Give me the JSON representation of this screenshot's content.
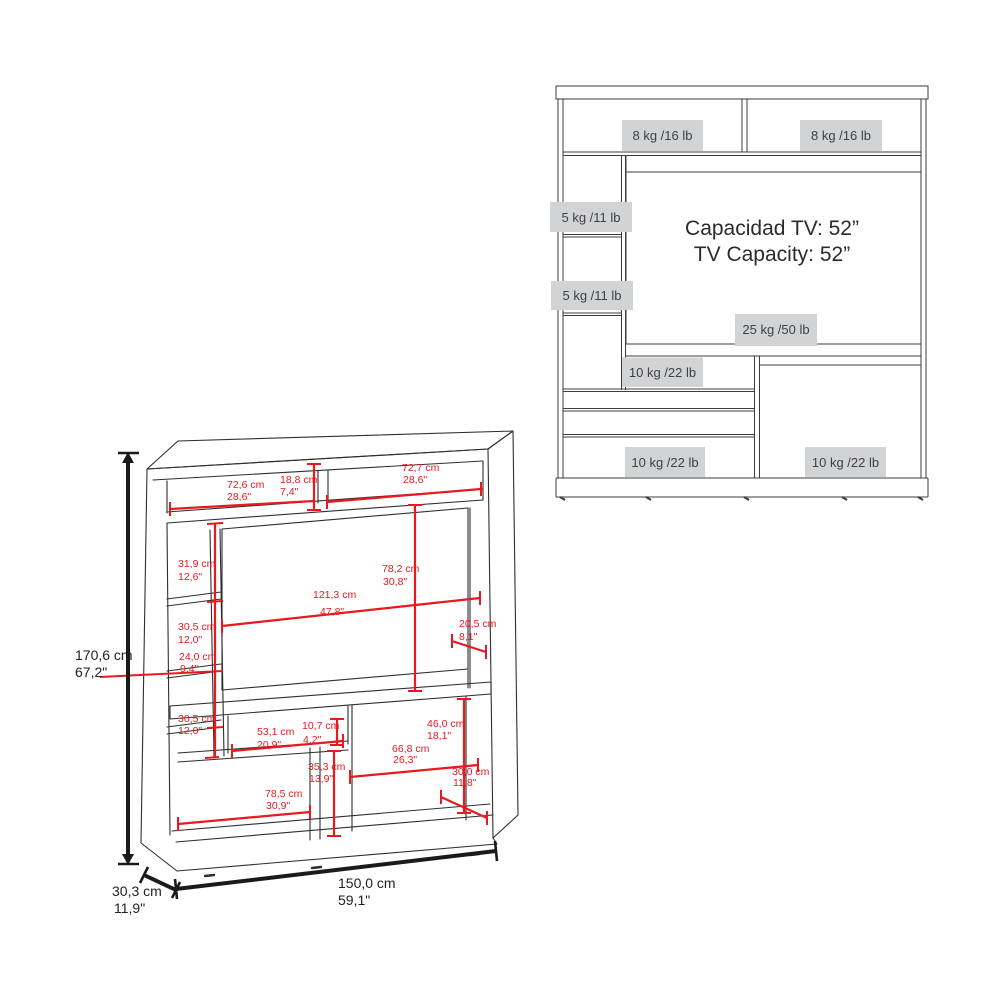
{
  "left_diagram": {
    "overall": {
      "height": {
        "cm": "170,6 cm",
        "in": "67,2\""
      },
      "width": {
        "cm": "150,0 cm",
        "in": "59,1\""
      },
      "depth": {
        "cm": "30,3 cm",
        "in": "11,9\""
      }
    },
    "dims": [
      {
        "id": "top-left-compartment-width",
        "cm": "72,6 cm",
        "in": "28,6\""
      },
      {
        "id": "hutch-compartment-height",
        "cm": "18,8 cm",
        "in": "7,4\""
      },
      {
        "id": "top-right-compartment-width",
        "cm": "72,7 cm",
        "in": "28,6\""
      },
      {
        "id": "side-cubby-1-height",
        "cm": "31,9 cm",
        "in": "12,6\""
      },
      {
        "id": "side-cubby-2-height",
        "cm": "30,5 cm",
        "in": "12,0\""
      },
      {
        "id": "side-cubby-3-height",
        "cm": "24,0 cm",
        "in": "9,4\""
      },
      {
        "id": "side-cubby-4-height",
        "cm": "30,5 cm",
        "in": "12,0\""
      },
      {
        "id": "tv-area-width",
        "cm": "121,3 cm",
        "in": "47,8\""
      },
      {
        "id": "tv-area-height",
        "cm": "78,2 cm",
        "in": "30,8\""
      },
      {
        "id": "side-niche-depth",
        "cm": "20,5 cm",
        "in": "8,1\""
      },
      {
        "id": "media-slot-width",
        "cm": "53,1 cm",
        "in": "20,9\""
      },
      {
        "id": "media-slot-height",
        "cm": "10,7 cm",
        "in": "4,2\""
      },
      {
        "id": "bottom-right-comp-height",
        "cm": "46,0 cm",
        "in": "18,1\""
      },
      {
        "id": "bottom-right-comp-width",
        "cm": "66,8 cm",
        "in": "26,3\""
      },
      {
        "id": "bottom-left-comp-height",
        "cm": "35,3 cm",
        "in": "13,9\""
      },
      {
        "id": "bottom-left-comp-width",
        "cm": "78,5 cm",
        "in": "30,9\""
      },
      {
        "id": "bottom-right-depth",
        "cm": "30,0 cm",
        "in": "11,8\""
      }
    ]
  },
  "right_diagram": {
    "tv_capacity_line1": "Capacidad TV: 52”",
    "tv_capacity_line2": "TV Capacity: 52”",
    "labels": [
      {
        "id": "top-left-shelf",
        "text": "8 kg /16 lb"
      },
      {
        "id": "top-right-shelf",
        "text": "8 kg /16 lb"
      },
      {
        "id": "side-shelf-1",
        "text": "5 kg /11 lb"
      },
      {
        "id": "side-shelf-2",
        "text": "5 kg /11 lb"
      },
      {
        "id": "main-shelf",
        "text": "25 kg /50 lb"
      },
      {
        "id": "middle-shelf",
        "text": "10 kg /22 lb"
      },
      {
        "id": "bottom-left-shelf",
        "text": "10 kg /22 lb"
      },
      {
        "id": "bottom-right-shelf",
        "text": "10 kg /22 lb"
      }
    ]
  },
  "colors": {
    "dimension_red": "#e8191f",
    "structure_line": "#2f2f31",
    "label_box_gray": "#d2d3d4",
    "label_text_gray": "#414042"
  }
}
